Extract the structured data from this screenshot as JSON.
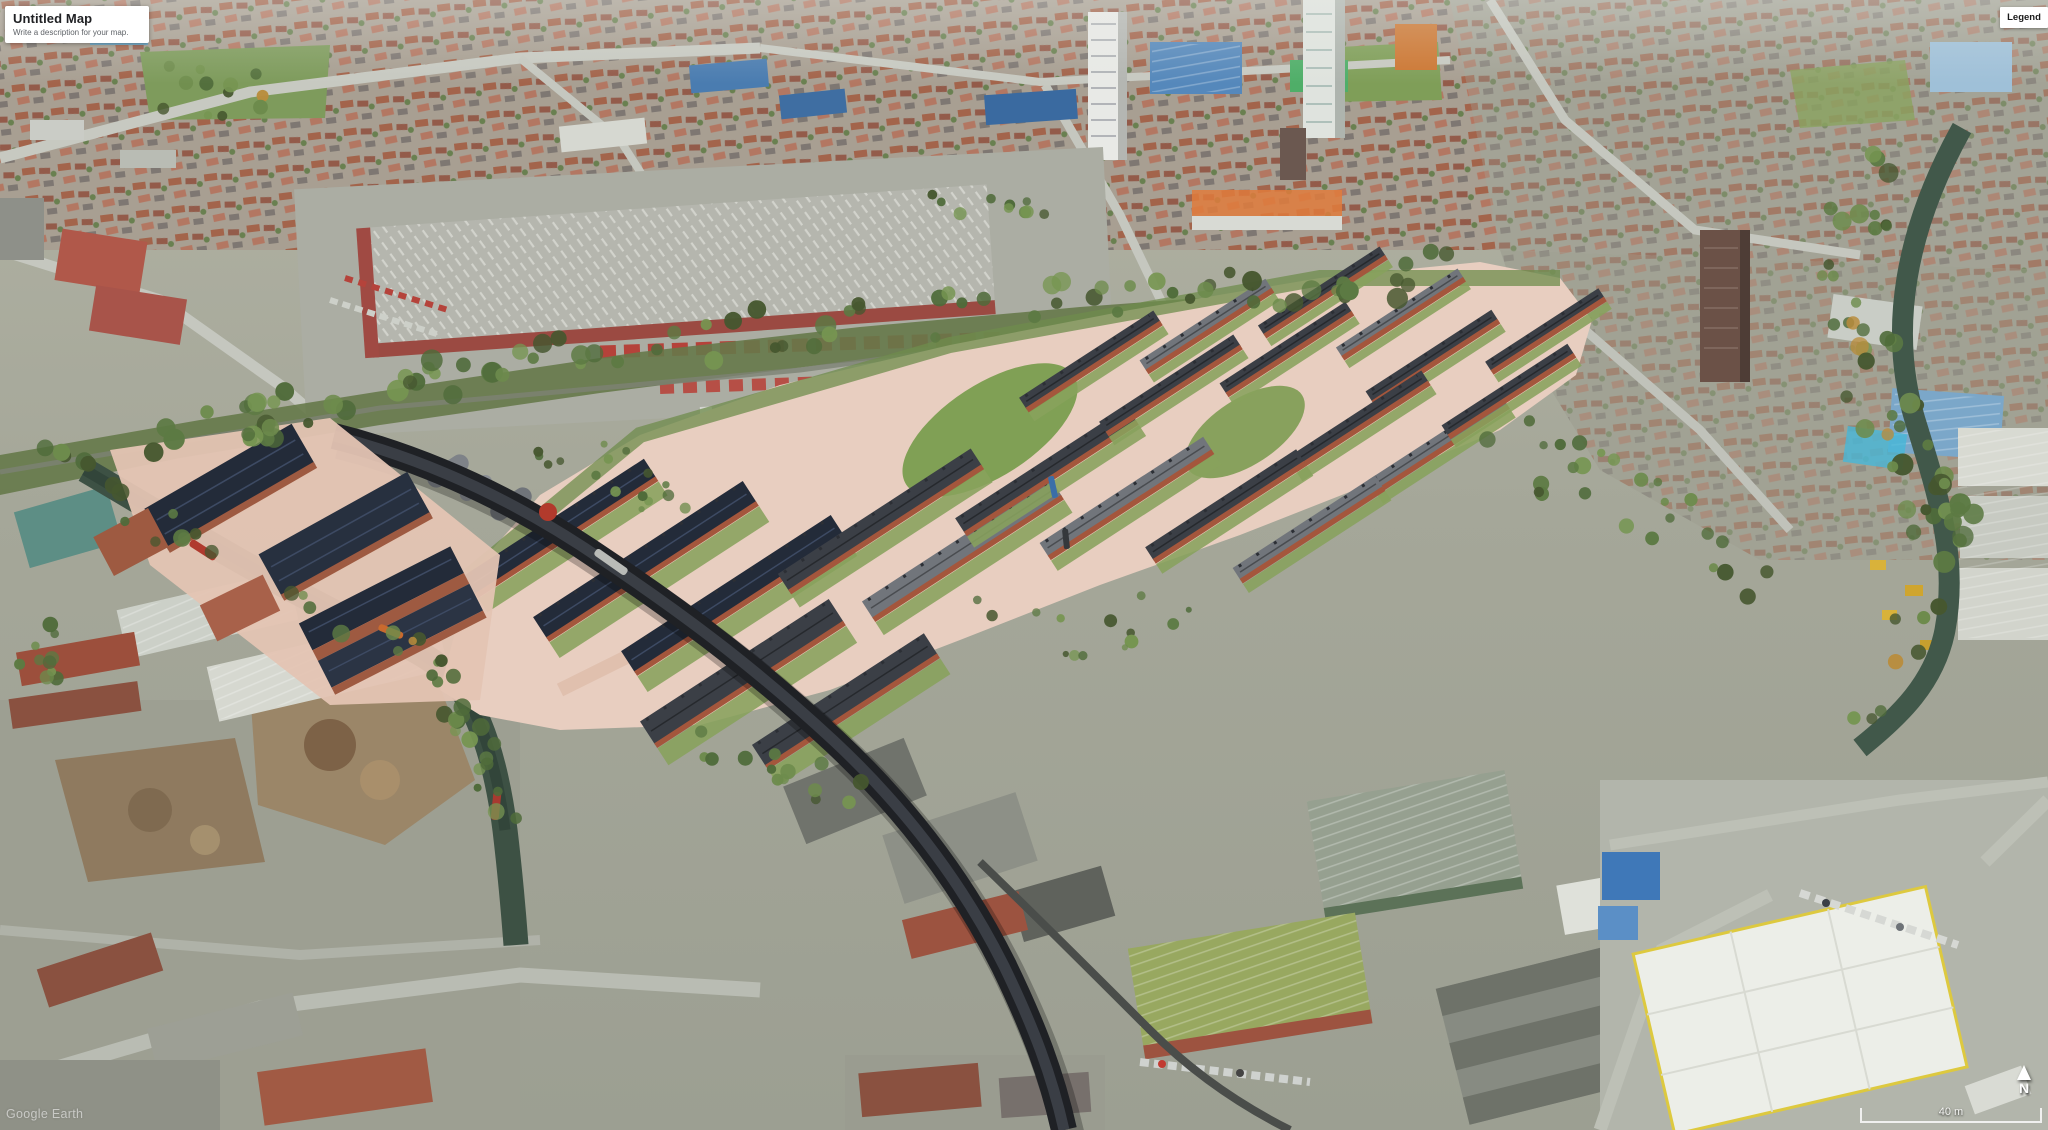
{
  "header": {
    "map_title": "Untitled Map",
    "map_subtitle": "Write a description for your map."
  },
  "legend": {
    "label": "Legend"
  },
  "map_controls": {
    "compass_label": "N",
    "scale_label": "40 m"
  },
  "watermark": {
    "label": "Google Earth"
  },
  "colors": {
    "panel_bg": "#ffffff",
    "title_text": "#202124",
    "subtitle_text": "#5f6368",
    "overlay_text": "#ffffff"
  }
}
